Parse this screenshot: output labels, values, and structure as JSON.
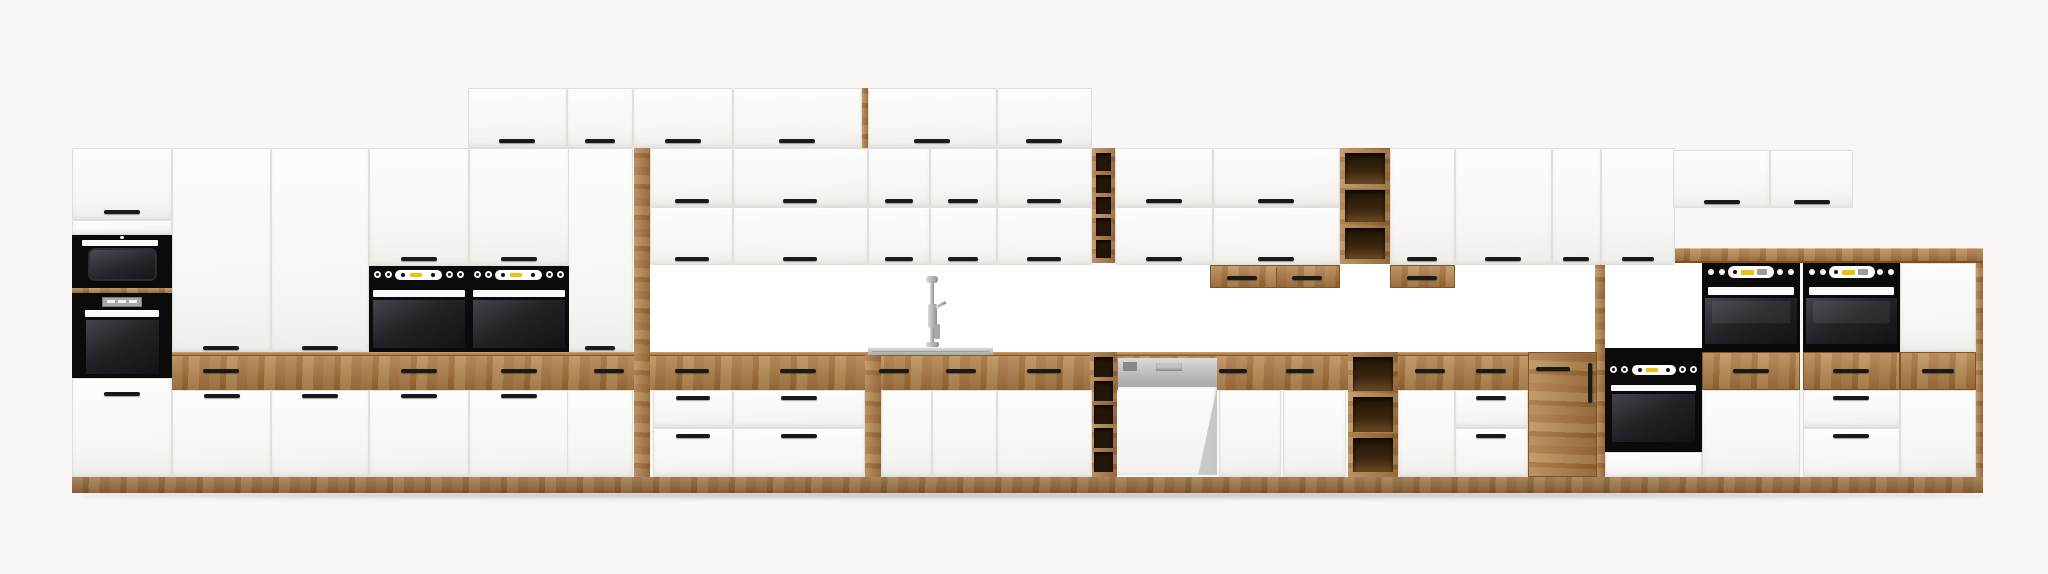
{
  "meta": {
    "kind": "furniture-product-render",
    "subject": "long modular kitchen cabinet set elevation, white fronts with oak accents and black built-in appliances",
    "canvas": {
      "width": 2048,
      "height": 574
    }
  },
  "palette": {
    "bg": "#f8f7f5",
    "front": "#fcfcfb",
    "gap": "#e1dfda",
    "oak1": "#b2804a",
    "oak2": "#a06c33",
    "oak3": "#bd8d55",
    "oak4": "#aa7640",
    "handle": "#191919",
    "black": "#0b0b0c",
    "yellow": "#eec20c",
    "steel": "#c7c9cb",
    "chrome": "#b9bcbf"
  },
  "inventory": {
    "appliances": [
      "built-in-microwave",
      "tall-unit-oven",
      "double-built-in-ovens-mid",
      "raised-double-ovens-right",
      "built-under-oven",
      "dishwasher-semi-integrated",
      "inset-sink",
      "tall-faucet"
    ],
    "oak_features": [
      "counter-drawer-band",
      "plinth",
      "wine-rack-upper",
      "wine-rack-lower",
      "open-shelf-upper",
      "open-shelf-lower",
      "under-cabinet-drawer-boxes",
      "oak-cabinet-door",
      "worktop-board-right"
    ]
  },
  "parts": [
    {
      "t": "white",
      "n": "niche-backsplash",
      "x": 650,
      "y": 264,
      "w": 945,
      "h": 88
    },
    {
      "t": "white",
      "n": "raised-niche-back",
      "x": 1605,
      "y": 263,
      "w": 97,
      "h": 85
    },
    {
      "t": "band",
      "n": "oak-top-drawer-band",
      "x": 172,
      "y": 352,
      "w": 1423,
      "h": 38
    },
    {
      "t": "oakv",
      "n": "oak-side-filler",
      "x": 634,
      "y": 148,
      "w": 16,
      "h": 329
    },
    {
      "t": "oakv",
      "n": "oak-filler-narrow",
      "x": 865,
      "y": 352,
      "w": 16,
      "h": 125
    },
    {
      "t": "plinth",
      "n": "plinth",
      "x": 72,
      "y": 477,
      "w": 1911,
      "h": 16
    },
    {
      "t": "board",
      "n": "worktop-board",
      "x": 1597,
      "y": 248,
      "w": 386,
      "h": 15
    },
    {
      "t": "oakv",
      "n": "board-support-pillar",
      "x": 1595,
      "y": 263,
      "w": 10,
      "h": 214
    },
    {
      "t": "oakv",
      "n": "side-panel-right",
      "x": 1976,
      "y": 263,
      "w": 7,
      "h": 214
    },
    {
      "t": "oakv",
      "n": "top-row-side-panel",
      "x": 862,
      "y": 88,
      "w": 6,
      "h": 60
    },
    {
      "t": "rack",
      "n": "wine-rack-upper",
      "x": 1092,
      "y": 148,
      "w": 23,
      "h": 115,
      "c": 5
    },
    {
      "t": "rack",
      "n": "wine-rack-lower",
      "x": 1090,
      "y": 352,
      "w": 27,
      "h": 125,
      "c": 5
    },
    {
      "t": "shelf",
      "n": "open-shelf-upper",
      "x": 1340,
      "y": 148,
      "w": 50,
      "h": 116,
      "c": 3
    },
    {
      "t": "shelf",
      "n": "open-shelf-lower",
      "x": 1348,
      "y": 352,
      "w": 50,
      "h": 125,
      "c": 3
    },
    {
      "t": "oakbox",
      "n": "under-cabinet-drawer-box",
      "x": 1210,
      "y": 265,
      "w": 130,
      "h": 23
    },
    {
      "t": "oakbox",
      "n": "under-cabinet-drawer-box",
      "x": 1390,
      "y": 265,
      "w": 65,
      "h": 23
    },
    {
      "t": "oakdoorpart",
      "n": "oak-cabinet-door",
      "x": 1528,
      "y": 352,
      "w": 69,
      "h": 125
    },
    {
      "t": "door",
      "n": "top-row-door",
      "x": 468,
      "y": 88,
      "w": 99,
      "h": 60
    },
    {
      "t": "door",
      "n": "top-row-door",
      "x": 567,
      "y": 88,
      "w": 66,
      "h": 60
    },
    {
      "t": "door",
      "n": "top-row-door",
      "x": 633,
      "y": 88,
      "w": 100,
      "h": 60
    },
    {
      "t": "door",
      "n": "top-row-door",
      "x": 733,
      "y": 88,
      "w": 129,
      "h": 60
    },
    {
      "t": "door",
      "n": "top-row-door",
      "x": 868,
      "y": 88,
      "w": 129,
      "h": 60
    },
    {
      "t": "door",
      "n": "top-row-door",
      "x": 997,
      "y": 88,
      "w": 95,
      "h": 60
    },
    {
      "t": "door",
      "n": "tower-top-door",
      "x": 72,
      "y": 148,
      "w": 100,
      "h": 72
    },
    {
      "t": "door",
      "n": "tower-filler",
      "x": 72,
      "y": 220,
      "w": 100,
      "h": 15
    },
    {
      "t": "door",
      "n": "tower-bottom-door",
      "x": 72,
      "y": 378,
      "w": 100,
      "h": 99
    },
    {
      "t": "door",
      "n": "tall-pantry-door",
      "x": 172,
      "y": 148,
      "w": 99,
      "h": 204
    },
    {
      "t": "door",
      "n": "tall-pantry-door",
      "x": 271,
      "y": 148,
      "w": 98,
      "h": 204
    },
    {
      "t": "door",
      "n": "tall-pantry-door",
      "x": 567,
      "y": 148,
      "w": 66,
      "h": 204
    },
    {
      "t": "door",
      "n": "oven-housing-upper-door",
      "x": 369,
      "y": 148,
      "w": 100,
      "h": 118
    },
    {
      "t": "door",
      "n": "oven-housing-upper-door",
      "x": 469,
      "y": 148,
      "w": 100,
      "h": 118
    },
    {
      "t": "door",
      "n": "wall-door",
      "x": 650,
      "y": 148,
      "w": 83,
      "h": 59
    },
    {
      "t": "door",
      "n": "wall-door",
      "x": 733,
      "y": 148,
      "w": 135,
      "h": 59
    },
    {
      "t": "door",
      "n": "wall-door",
      "x": 868,
      "y": 148,
      "w": 62,
      "h": 59
    },
    {
      "t": "door",
      "n": "wall-door",
      "x": 930,
      "y": 148,
      "w": 67,
      "h": 59
    },
    {
      "t": "door",
      "n": "wall-door",
      "x": 997,
      "y": 148,
      "w": 95,
      "h": 59
    },
    {
      "t": "door",
      "n": "wall-door",
      "x": 650,
      "y": 207,
      "w": 83,
      "h": 58
    },
    {
      "t": "door",
      "n": "wall-door",
      "x": 733,
      "y": 207,
      "w": 135,
      "h": 58
    },
    {
      "t": "door",
      "n": "wall-door",
      "x": 868,
      "y": 207,
      "w": 62,
      "h": 58
    },
    {
      "t": "door",
      "n": "wall-door",
      "x": 930,
      "y": 207,
      "w": 67,
      "h": 58
    },
    {
      "t": "door",
      "n": "wall-door",
      "x": 997,
      "y": 207,
      "w": 95,
      "h": 58
    },
    {
      "t": "door",
      "n": "wall-door",
      "x": 1115,
      "y": 148,
      "w": 98,
      "h": 59
    },
    {
      "t": "door",
      "n": "wall-door",
      "x": 1213,
      "y": 148,
      "w": 127,
      "h": 59
    },
    {
      "t": "door",
      "n": "wall-door",
      "x": 1115,
      "y": 207,
      "w": 98,
      "h": 58
    },
    {
      "t": "door",
      "n": "wall-door",
      "x": 1213,
      "y": 207,
      "w": 127,
      "h": 58
    },
    {
      "t": "door",
      "n": "wall-tall-door",
      "x": 1390,
      "y": 148,
      "w": 65,
      "h": 117
    },
    {
      "t": "door",
      "n": "wall-tall-door",
      "x": 1455,
      "y": 148,
      "w": 97,
      "h": 117
    },
    {
      "t": "door",
      "n": "wall-tall-door",
      "x": 1552,
      "y": 148,
      "w": 49,
      "h": 117
    },
    {
      "t": "door",
      "n": "wall-tall-door",
      "x": 1601,
      "y": 148,
      "w": 74,
      "h": 117
    },
    {
      "t": "door",
      "n": "short-wall-door",
      "x": 1673,
      "y": 150,
      "w": 97,
      "h": 58
    },
    {
      "t": "door",
      "n": "short-wall-door",
      "x": 1770,
      "y": 150,
      "w": 83,
      "h": 58
    },
    {
      "t": "door",
      "n": "base-door",
      "x": 172,
      "y": 390,
      "w": 99,
      "h": 87
    },
    {
      "t": "door",
      "n": "base-door",
      "x": 271,
      "y": 390,
      "w": 98,
      "h": 87
    },
    {
      "t": "door",
      "n": "base-door",
      "x": 369,
      "y": 390,
      "w": 100,
      "h": 87
    },
    {
      "t": "door",
      "n": "base-door",
      "x": 469,
      "y": 390,
      "w": 100,
      "h": 87
    },
    {
      "t": "door",
      "n": "base-door",
      "x": 567,
      "y": 390,
      "w": 66,
      "h": 87
    },
    {
      "t": "door",
      "n": "sink-base-door",
      "x": 881,
      "y": 390,
      "w": 51,
      "h": 87
    },
    {
      "t": "door",
      "n": "sink-base-door",
      "x": 932,
      "y": 390,
      "w": 65,
      "h": 87
    },
    {
      "t": "door",
      "n": "base-door",
      "x": 997,
      "y": 390,
      "w": 95,
      "h": 87
    },
    {
      "t": "door",
      "n": "base-door",
      "x": 1219,
      "y": 390,
      "w": 62,
      "h": 87
    },
    {
      "t": "door",
      "n": "base-door",
      "x": 1283,
      "y": 390,
      "w": 63,
      "h": 87
    },
    {
      "t": "door",
      "n": "base-door",
      "x": 1398,
      "y": 390,
      "w": 57,
      "h": 87
    },
    {
      "t": "door",
      "n": "base-door",
      "x": 1702,
      "y": 390,
      "w": 98,
      "h": 87
    },
    {
      "t": "door",
      "n": "base-door",
      "x": 1900,
      "y": 390,
      "w": 76,
      "h": 87
    },
    {
      "t": "door",
      "n": "filler-front",
      "x": 1900,
      "y": 263,
      "w": 76,
      "h": 89
    },
    {
      "t": "door",
      "n": "base-drawer",
      "x": 653,
      "y": 390,
      "w": 80,
      "h": 38
    },
    {
      "t": "door",
      "n": "base-drawer",
      "x": 653,
      "y": 428,
      "w": 80,
      "h": 49
    },
    {
      "t": "door",
      "n": "base-drawer",
      "x": 733,
      "y": 390,
      "w": 132,
      "h": 38
    },
    {
      "t": "door",
      "n": "base-drawer",
      "x": 733,
      "y": 428,
      "w": 132,
      "h": 49
    },
    {
      "t": "door",
      "n": "base-drawer",
      "x": 1455,
      "y": 390,
      "w": 73,
      "h": 38
    },
    {
      "t": "door",
      "n": "base-drawer",
      "x": 1455,
      "y": 428,
      "w": 73,
      "h": 49
    },
    {
      "t": "door",
      "n": "base-drawer",
      "x": 1803,
      "y": 390,
      "w": 97,
      "h": 38
    },
    {
      "t": "door",
      "n": "base-drawer",
      "x": 1803,
      "y": 428,
      "w": 97,
      "h": 49
    },
    {
      "t": "oakdrawer",
      "n": "oak-drawer-front",
      "x": 1702,
      "y": 352,
      "w": 98,
      "h": 38
    },
    {
      "t": "oakdrawer",
      "n": "oak-drawer-front",
      "x": 1803,
      "y": 352,
      "w": 97,
      "h": 38
    },
    {
      "t": "oakdrawer",
      "n": "oak-drawer-front",
      "x": 1900,
      "y": 352,
      "w": 76,
      "h": 38
    },
    {
      "t": "mw",
      "n": "built-in-microwave",
      "x": 72,
      "y": 235,
      "w": 100,
      "h": 53
    },
    {
      "t": "sliver",
      "n": "oak-divider-strip",
      "x": 72,
      "y": 288,
      "w": 100,
      "h": 5
    },
    {
      "t": "toven",
      "n": "tower-built-in-oven",
      "x": 72,
      "y": 293,
      "w": 100,
      "h": 85
    },
    {
      "t": "oven",
      "n": "built-in-oven-left",
      "x": 369,
      "y": 266,
      "w": 100,
      "h": 86
    },
    {
      "t": "oven",
      "n": "built-in-oven-right",
      "x": 469,
      "y": 266,
      "w": 100,
      "h": 86
    },
    {
      "t": "roven",
      "n": "raised-built-in-oven-left",
      "x": 1702,
      "y": 263,
      "w": 98,
      "h": 89
    },
    {
      "t": "roven",
      "n": "raised-built-in-oven-right",
      "x": 1803,
      "y": 263,
      "w": 97,
      "h": 89
    },
    {
      "t": "uoven",
      "n": "built-under-oven",
      "x": 1605,
      "y": 348,
      "w": 97,
      "h": 129
    },
    {
      "t": "dw",
      "n": "dishwasher-semi-integrated",
      "x": 1118,
      "y": 358,
      "w": 99,
      "h": 117
    },
    {
      "t": "sink",
      "n": "inset-sink-deck",
      "x": 868,
      "y": 347,
      "w": 125,
      "h": 8
    },
    {
      "t": "faucet",
      "n": "kitchen-faucet",
      "x": 922,
      "y": 276,
      "w": 24,
      "h": 71
    },
    {
      "t": "shadow",
      "n": "floor-shadow",
      "x": 78,
      "y": 492,
      "w": 1908,
      "h": 6
    }
  ],
  "handles": [
    {
      "cx": 517,
      "y": 139,
      "l": 36
    },
    {
      "cx": 600,
      "y": 139,
      "l": 30
    },
    {
      "cx": 683,
      "y": 139,
      "l": 36
    },
    {
      "cx": 797,
      "y": 139,
      "l": 36
    },
    {
      "cx": 932,
      "y": 139,
      "l": 36
    },
    {
      "cx": 1044,
      "y": 139,
      "l": 36
    },
    {
      "cx": 122,
      "y": 210,
      "l": 36
    },
    {
      "cx": 122,
      "y": 392,
      "l": 36
    },
    {
      "cx": 221,
      "y": 346,
      "l": 36
    },
    {
      "cx": 320,
      "y": 346,
      "l": 36
    },
    {
      "cx": 600,
      "y": 346,
      "l": 30
    },
    {
      "cx": 419,
      "y": 257,
      "l": 36
    },
    {
      "cx": 519,
      "y": 257,
      "l": 36
    },
    {
      "cx": 692,
      "y": 199,
      "l": 34
    },
    {
      "cx": 800,
      "y": 199,
      "l": 34
    },
    {
      "cx": 899,
      "y": 199,
      "l": 28
    },
    {
      "cx": 963,
      "y": 199,
      "l": 30
    },
    {
      "cx": 1044,
      "y": 199,
      "l": 34
    },
    {
      "cx": 692,
      "y": 257,
      "l": 34
    },
    {
      "cx": 800,
      "y": 257,
      "l": 34
    },
    {
      "cx": 899,
      "y": 257,
      "l": 28
    },
    {
      "cx": 963,
      "y": 257,
      "l": 30
    },
    {
      "cx": 1044,
      "y": 257,
      "l": 34
    },
    {
      "cx": 1164,
      "y": 199,
      "l": 36
    },
    {
      "cx": 1276,
      "y": 199,
      "l": 36
    },
    {
      "cx": 1164,
      "y": 257,
      "l": 36
    },
    {
      "cx": 1276,
      "y": 257,
      "l": 36
    },
    {
      "cx": 1422,
      "y": 257,
      "l": 30
    },
    {
      "cx": 1503,
      "y": 257,
      "l": 36
    },
    {
      "cx": 1576,
      "y": 257,
      "l": 26
    },
    {
      "cx": 1638,
      "y": 257,
      "l": 32
    },
    {
      "cx": 1722,
      "y": 200,
      "l": 36
    },
    {
      "cx": 1812,
      "y": 200,
      "l": 36
    },
    {
      "cx": 1242,
      "y": 276,
      "l": 30
    },
    {
      "cx": 1307,
      "y": 276,
      "l": 30
    },
    {
      "cx": 1422,
      "y": 276,
      "l": 30
    },
    {
      "cx": 221,
      "y": 369,
      "l": 36
    },
    {
      "cx": 419,
      "y": 369,
      "l": 36
    },
    {
      "cx": 519,
      "y": 369,
      "l": 36
    },
    {
      "cx": 609,
      "y": 369,
      "l": 30
    },
    {
      "cx": 692,
      "y": 369,
      "l": 34
    },
    {
      "cx": 798,
      "y": 369,
      "l": 36
    },
    {
      "cx": 894,
      "y": 369,
      "l": 30
    },
    {
      "cx": 961,
      "y": 369,
      "l": 30
    },
    {
      "cx": 1044,
      "y": 369,
      "l": 34
    },
    {
      "cx": 1233,
      "y": 369,
      "l": 28
    },
    {
      "cx": 1300,
      "y": 369,
      "l": 28
    },
    {
      "cx": 1430,
      "y": 369,
      "l": 30
    },
    {
      "cx": 1491,
      "y": 369,
      "l": 30
    },
    {
      "cx": 1553,
      "y": 367,
      "l": 34
    },
    {
      "cx": 1751,
      "y": 369,
      "l": 36
    },
    {
      "cx": 1851,
      "y": 369,
      "l": 36
    },
    {
      "cx": 1938,
      "y": 369,
      "l": 32
    },
    {
      "cx": 222,
      "y": 394,
      "l": 36
    },
    {
      "cx": 320,
      "y": 394,
      "l": 36
    },
    {
      "cx": 419,
      "y": 394,
      "l": 36
    },
    {
      "cx": 519,
      "y": 394,
      "l": 36
    },
    {
      "cx": 693,
      "y": 396,
      "l": 34
    },
    {
      "cx": 799,
      "y": 396,
      "l": 36
    },
    {
      "cx": 1491,
      "y": 396,
      "l": 30
    },
    {
      "cx": 1851,
      "y": 396,
      "l": 36
    },
    {
      "cx": 693,
      "y": 434,
      "l": 34
    },
    {
      "cx": 799,
      "y": 434,
      "l": 36
    },
    {
      "cx": 1491,
      "y": 434,
      "l": 30
    },
    {
      "cx": 1851,
      "y": 434,
      "l": 36
    },
    {
      "cx": 1590,
      "y": 363,
      "l": 40,
      "v": 1
    }
  ]
}
